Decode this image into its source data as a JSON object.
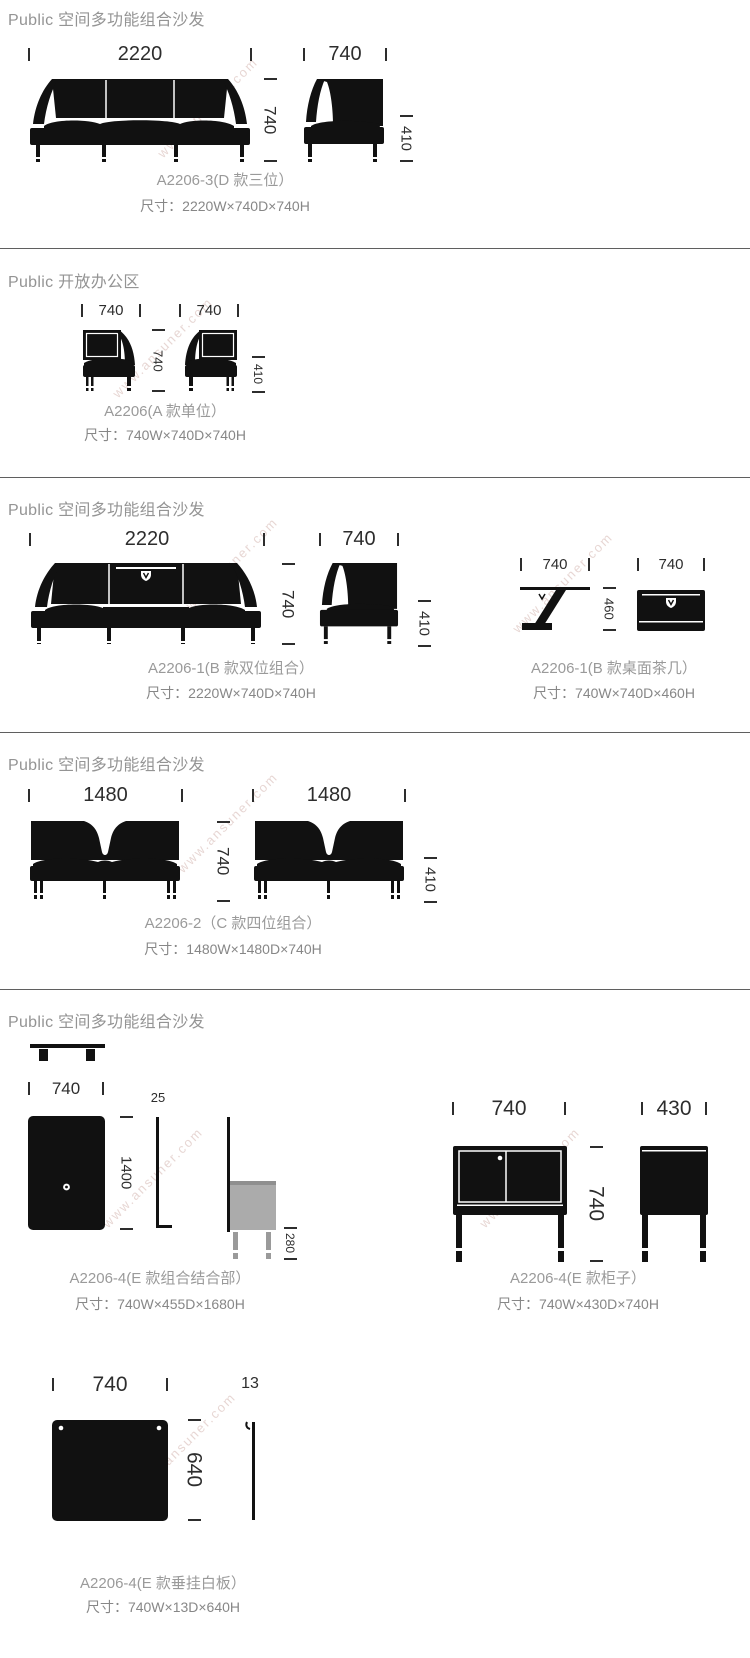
{
  "watermark": "www.ansuner.com",
  "colors": {
    "ink": "#111111",
    "dim_text": "#2d2d2d",
    "heading_gray": "#949494",
    "caption_gray": "#9a9a9a",
    "divider": "#5f5f5f",
    "gray_box": "#ababab"
  },
  "s1": {
    "header": "Public 空间多功能组合沙发",
    "front_width": "2220",
    "side_width": "740",
    "height": "740",
    "seat_height": "410",
    "caption": "A2206-3(D 款三位）",
    "size": "尺寸：2220W×740D×740H"
  },
  "s2": {
    "header": "Public 开放办公区",
    "left_width": "740",
    "right_width": "740",
    "height": "740",
    "seat_height": "410",
    "caption": "A2206(A 款单位）",
    "size": "尺寸：740W×740D×740H"
  },
  "s3": {
    "header": "Public 空间多功能组合沙发",
    "sofa": {
      "front_width": "2220",
      "side_width": "740",
      "height": "740",
      "seat_height": "410",
      "caption": "A2206-1(B 款双位组合）",
      "size": "尺寸：2220W×740D×740H"
    },
    "table": {
      "side_width": "740",
      "front_width": "740",
      "height": "460",
      "caption": "A2206-1(B 款桌面茶几）",
      "size": "尺寸：740W×740D×460H"
    }
  },
  "s4": {
    "header": "Public 空间多功能组合沙发",
    "left_width": "1480",
    "right_width": "1480",
    "height": "740",
    "seat_height": "410",
    "caption": "A2206-2（C 款四位组合）",
    "size": "尺寸：1480W×1480D×740H"
  },
  "s5": {
    "header": "Public 空间多功能组合沙发",
    "combo": {
      "width": "740",
      "panel_thickness": "25",
      "panel_height": "1400",
      "box_height": "280",
      "caption": "A2206-4(E 款组合结合部）",
      "size": "尺寸：740W×455D×1680H"
    },
    "cabinet": {
      "front_width": "740",
      "side_width": "430",
      "height": "740",
      "caption": "A2206-4(E 款柜子）",
      "size": "尺寸：740W×430D×740H"
    },
    "board": {
      "width": "740",
      "thickness": "13",
      "height": "640",
      "caption": "A2206-4(E 款垂挂白板）",
      "size": "尺寸：740W×13D×640H"
    }
  }
}
